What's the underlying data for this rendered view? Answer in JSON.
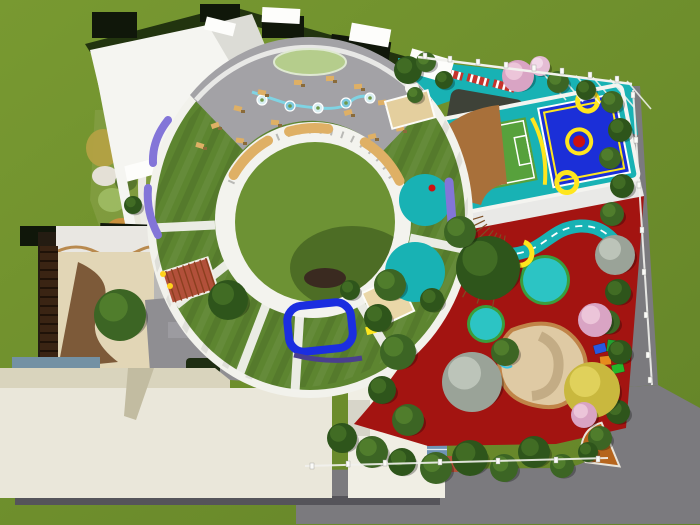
{
  "scene": {
    "description": "aerial 3D rendering of a kindergarten campus: circular ring building with green roof and central lawn courtyard, rooftop terrace, west flower garden, sports deck with mini soccer field and basketball court, red playground with winding teal path, sand pit, tree belt and perimeter road"
  },
  "palette": {
    "grass_light": "#789931",
    "grass_dark": "#648428",
    "road": "#7b7a7e",
    "road_dark": "#6e6d71",
    "shadow": "#55545a",
    "roof_dark": "#10170a",
    "hedge": "#22340f",
    "white": "#f5f5f1",
    "white_dim": "#dcdcd6",
    "white_bright": "#fdfdfb",
    "cream": "#eae7da",
    "beige": "#d9d4bd",
    "beige_dark": "#c2bca1",
    "wing": "#f0eee4",
    "notch": "#d7d5c9",
    "glass": "#6f93b4",
    "brickred": "#b2503a",
    "plaza": "#8f8e92",
    "plaza_dark": "#6f6e72",
    "plaza_box": "#9c9ba0",
    "dkgreenbox": "#1e2d12",
    "interior_floor": "#e2d6b6",
    "interior_wave": "#6b4423",
    "shelf": "#3a2413",
    "bluegray": "#7391a4",
    "lawn": "#5d8530",
    "rim": "#f2f2ec",
    "courtyard": "#6d9234",
    "band": "#f3f3ee",
    "terrace": "#a3a2a6",
    "terrace_edge": "#e9e9e7",
    "island": "#b5cd8c",
    "stream": "#7fd4e4",
    "bench": "#dfb065",
    "wood": "#a8703a",
    "wood_line": "#7c4e24",
    "purple": "#8375d8",
    "purple_dark": "#4a3f8f",
    "teal": "#18b2b4",
    "soccer": "#57a13c",
    "court_blue": "#1b2fd8",
    "yellow": "#ffe61e",
    "red_dot": "#cc1111",
    "red_ground": "#a31411",
    "track_red": "#c6332c",
    "dark_play": "#3e4238",
    "circ_teal": "#2cc4c4",
    "circ_rim": "#3a9e3c",
    "sand": "#dfcaa4",
    "sand_edge": "#c08448",
    "sand_shadow": "#b7a077",
    "amph": "#b5651d",
    "amph_dark": "#8a4a12",
    "pond": "#1b2ee0",
    "duck": "#ffd21c",
    "tree": {
      "g1": [
        "#3c6524",
        "#527f2e"
      ],
      "g2": [
        "#2e551b",
        "#446f26"
      ],
      "pk": [
        "#d9a4c4",
        "#edc9dc"
      ],
      "pk2": [
        "#e4bcd4",
        "#f3dcea"
      ],
      "yl": [
        "#c9b83e",
        "#e2d45e"
      ],
      "gy": [
        "#9aa398",
        "#c0c8bc"
      ]
    }
  },
  "trees": [
    {
      "x": 408,
      "y": 70,
      "r": 14,
      "t": "g2"
    },
    {
      "x": 426,
      "y": 62,
      "r": 10,
      "t": "g1"
    },
    {
      "x": 444,
      "y": 80,
      "r": 9,
      "t": "g2"
    },
    {
      "x": 518,
      "y": 76,
      "r": 16,
      "t": "pk"
    },
    {
      "x": 540,
      "y": 66,
      "r": 10,
      "t": "pk2"
    },
    {
      "x": 558,
      "y": 82,
      "r": 11,
      "t": "g1"
    },
    {
      "x": 586,
      "y": 90,
      "r": 10,
      "t": "g2"
    },
    {
      "x": 415,
      "y": 95,
      "r": 8,
      "t": "g1"
    },
    {
      "x": 612,
      "y": 102,
      "r": 11,
      "t": "g1"
    },
    {
      "x": 620,
      "y": 130,
      "r": 12,
      "t": "g2"
    },
    {
      "x": 610,
      "y": 158,
      "r": 11,
      "t": "g1"
    },
    {
      "x": 622,
      "y": 186,
      "r": 12,
      "t": "g2"
    },
    {
      "x": 612,
      "y": 214,
      "r": 12,
      "t": "g1"
    },
    {
      "x": 615,
      "y": 255,
      "r": 20,
      "t": "gy"
    },
    {
      "x": 618,
      "y": 292,
      "r": 13,
      "t": "g2"
    },
    {
      "x": 608,
      "y": 322,
      "r": 12,
      "t": "g1"
    },
    {
      "x": 620,
      "y": 352,
      "r": 12,
      "t": "g2"
    },
    {
      "x": 606,
      "y": 382,
      "r": 12,
      "t": "g1"
    },
    {
      "x": 618,
      "y": 412,
      "r": 12,
      "t": "g2"
    },
    {
      "x": 600,
      "y": 438,
      "r": 12,
      "t": "g1"
    },
    {
      "x": 595,
      "y": 320,
      "r": 17,
      "t": "pk"
    },
    {
      "x": 592,
      "y": 390,
      "r": 28,
      "t": "yl"
    },
    {
      "x": 584,
      "y": 415,
      "r": 13,
      "t": "pk"
    },
    {
      "x": 488,
      "y": 268,
      "r": 32,
      "t": "g2"
    },
    {
      "x": 460,
      "y": 232,
      "r": 16,
      "t": "g1"
    },
    {
      "x": 472,
      "y": 382,
      "r": 30,
      "t": "gy"
    },
    {
      "x": 505,
      "y": 352,
      "r": 14,
      "t": "g1"
    },
    {
      "x": 390,
      "y": 285,
      "r": 16,
      "t": "g1"
    },
    {
      "x": 378,
      "y": 318,
      "r": 14,
      "t": "g2"
    },
    {
      "x": 398,
      "y": 352,
      "r": 18,
      "t": "g1"
    },
    {
      "x": 382,
      "y": 390,
      "r": 14,
      "t": "g2"
    },
    {
      "x": 408,
      "y": 420,
      "r": 16,
      "t": "g1"
    },
    {
      "x": 432,
      "y": 300,
      "r": 12,
      "t": "g2"
    },
    {
      "x": 342,
      "y": 438,
      "r": 15,
      "t": "g2"
    },
    {
      "x": 372,
      "y": 452,
      "r": 16,
      "t": "g1"
    },
    {
      "x": 402,
      "y": 462,
      "r": 14,
      "t": "g2"
    },
    {
      "x": 436,
      "y": 468,
      "r": 16,
      "t": "g1"
    },
    {
      "x": 470,
      "y": 458,
      "r": 18,
      "t": "g2"
    },
    {
      "x": 504,
      "y": 468,
      "r": 14,
      "t": "g1"
    },
    {
      "x": 534,
      "y": 452,
      "r": 16,
      "t": "g2"
    },
    {
      "x": 562,
      "y": 466,
      "r": 12,
      "t": "g1"
    },
    {
      "x": 588,
      "y": 452,
      "r": 10,
      "t": "g2"
    },
    {
      "x": 120,
      "y": 315,
      "r": 26,
      "t": "g1"
    },
    {
      "x": 228,
      "y": 300,
      "r": 20,
      "t": "g2"
    },
    {
      "x": 133,
      "y": 205,
      "r": 9,
      "t": "g2"
    },
    {
      "x": 350,
      "y": 290,
      "r": 10,
      "t": "g2"
    }
  ],
  "garden": {
    "patches": [
      {
        "x": 103,
        "y": 148,
        "rx": 17,
        "ry": 19,
        "c": "#b3a143"
      },
      {
        "x": 105,
        "y": 176,
        "rx": 13,
        "ry": 10,
        "c": "#e9e4de"
      },
      {
        "x": 126,
        "y": 182,
        "rx": 11,
        "ry": 9,
        "c": "#55742c"
      },
      {
        "x": 112,
        "y": 200,
        "rx": 14,
        "ry": 12,
        "c": "#9dba62"
      },
      {
        "x": 122,
        "y": 230,
        "rx": 16,
        "ry": 12,
        "c": "#cf8f3d"
      },
      {
        "x": 128,
        "y": 250,
        "rx": 17,
        "ry": 12,
        "c": "#e6a9c6"
      },
      {
        "x": 135,
        "y": 218,
        "rx": 11,
        "ry": 8,
        "c": "#eeebe4"
      },
      {
        "x": 143,
        "y": 266,
        "rx": 10,
        "ry": 7,
        "c": "#e8c39a"
      }
    ]
  },
  "fences": {
    "top_posts": [
      [
        425,
        56
      ],
      [
        450,
        59
      ],
      [
        478,
        62
      ],
      [
        506,
        65
      ],
      [
        534,
        68
      ],
      [
        562,
        71
      ],
      [
        590,
        75
      ],
      [
        617,
        79
      ]
    ],
    "right_posts": [
      [
        633,
        95
      ],
      [
        636,
        140
      ],
      [
        639,
        185
      ],
      [
        642,
        230
      ],
      [
        644,
        272
      ],
      [
        646,
        315
      ],
      [
        648,
        355
      ],
      [
        650,
        380
      ]
    ],
    "bottom_posts": [
      [
        312,
        466
      ],
      [
        348,
        464
      ],
      [
        385,
        463
      ],
      [
        440,
        462
      ],
      [
        498,
        461
      ],
      [
        556,
        460
      ],
      [
        598,
        459
      ]
    ]
  },
  "terrace": {
    "furniture": [
      [
        215,
        125
      ],
      [
        200,
        145
      ],
      [
        238,
        108
      ],
      [
        262,
        92
      ],
      [
        240,
        140
      ],
      [
        275,
        122
      ],
      [
        298,
        82
      ],
      [
        330,
        78
      ],
      [
        358,
        86
      ],
      [
        382,
        102
      ],
      [
        400,
        128
      ],
      [
        372,
        136
      ],
      [
        348,
        112
      ],
      [
        300,
        132
      ],
      [
        410,
        118
      ]
    ],
    "stream_nodes": [
      [
        262,
        100
      ],
      [
        290,
        106
      ],
      [
        318,
        108
      ],
      [
        346,
        103
      ],
      [
        370,
        98
      ]
    ],
    "benches": [
      [
        -150,
        -120
      ],
      [
        -106,
        -82
      ],
      [
        -58,
        -26
      ]
    ]
  },
  "track_pieces": [
    [
      452,
      74
    ],
    [
      478,
      80
    ],
    [
      504,
      86
    ]
  ],
  "equipment": [
    {
      "x": 594,
      "y": 344,
      "w": 12,
      "h": 9,
      "c": "#2759e0"
    },
    {
      "x": 607,
      "y": 340,
      "w": 10,
      "h": 12,
      "c": "#22a12e"
    },
    {
      "x": 618,
      "y": 350,
      "w": 12,
      "h": 10,
      "c": "#0ea5b5"
    },
    {
      "x": 600,
      "y": 356,
      "w": 11,
      "h": 9,
      "c": "#e78b1d"
    },
    {
      "x": 612,
      "y": 364,
      "w": 12,
      "h": 9,
      "c": "#26b52a"
    },
    {
      "x": 596,
      "y": 366,
      "w": 9,
      "h": 8,
      "c": "#ccd31f"
    }
  ],
  "teal_circles": [
    {
      "x": 545,
      "y": 280,
      "r": 22
    },
    {
      "x": 486,
      "y": 324,
      "r": 16
    },
    {
      "x": 418,
      "y": 268,
      "r": 10
    }
  ],
  "ducks": [
    [
      163,
      274
    ],
    [
      170,
      286
    ]
  ]
}
